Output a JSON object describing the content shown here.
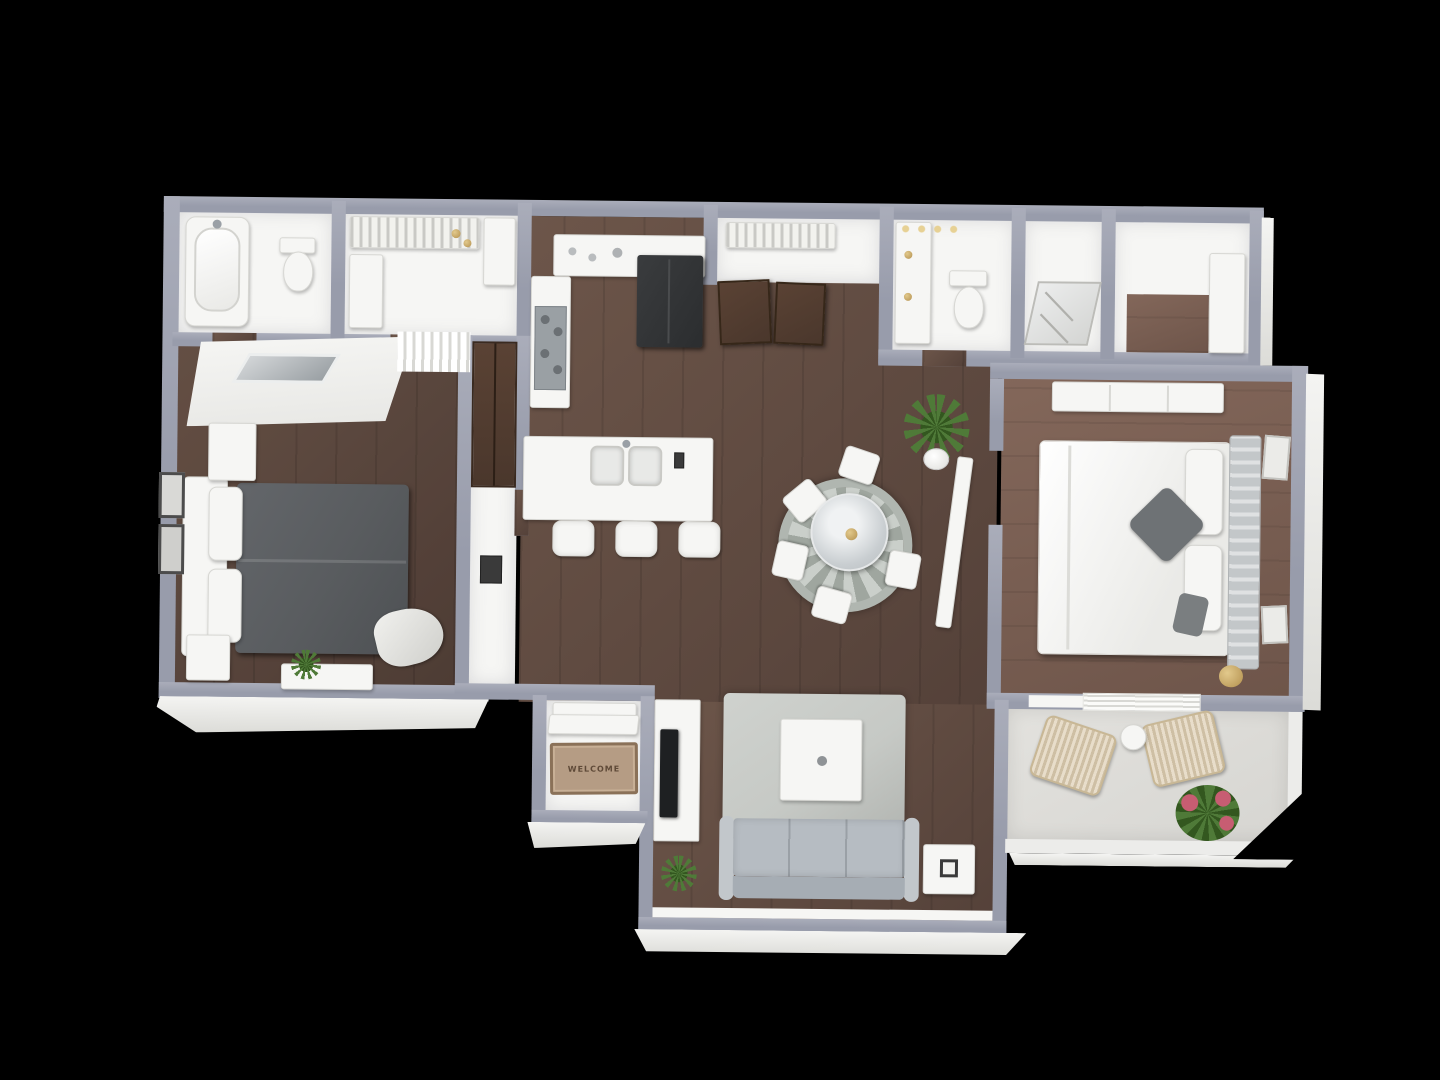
{
  "entry_mat": {
    "text": "WELCOME"
  },
  "colors": {
    "bg": "#000000",
    "wall": "#989cab",
    "wallHi": "#aaadba",
    "wallFace": "#ececea",
    "white": "#f6f6f4",
    "woodA": "#6d564a",
    "woodADark": "#544139",
    "woodB": "#83675a",
    "woodBDark": "#6e554a",
    "woodDoor": "#4a372c",
    "concrete": "#d6d5d1",
    "sofa": "#b6bcc2",
    "sofaBack": "#a6adb4",
    "sofaArm": "#c2c7cb",
    "rugLiving": "#c6c9c5",
    "bed1": "#595c5f",
    "pillowAccent": "#6e7275",
    "wicker": "#dbcbae",
    "leaf": "#4f7a38",
    "leafDark": "#33571f",
    "flower": "#c75d72",
    "gold": "#b3904e",
    "mat": "#b59c84",
    "matBorder": "#8a7158",
    "matText": "#5f4a38",
    "tv": "#1e2022",
    "fridge": "#2b2d2f",
    "stove": "#9aa0a4",
    "frameDark": "#3a3a3a"
  }
}
